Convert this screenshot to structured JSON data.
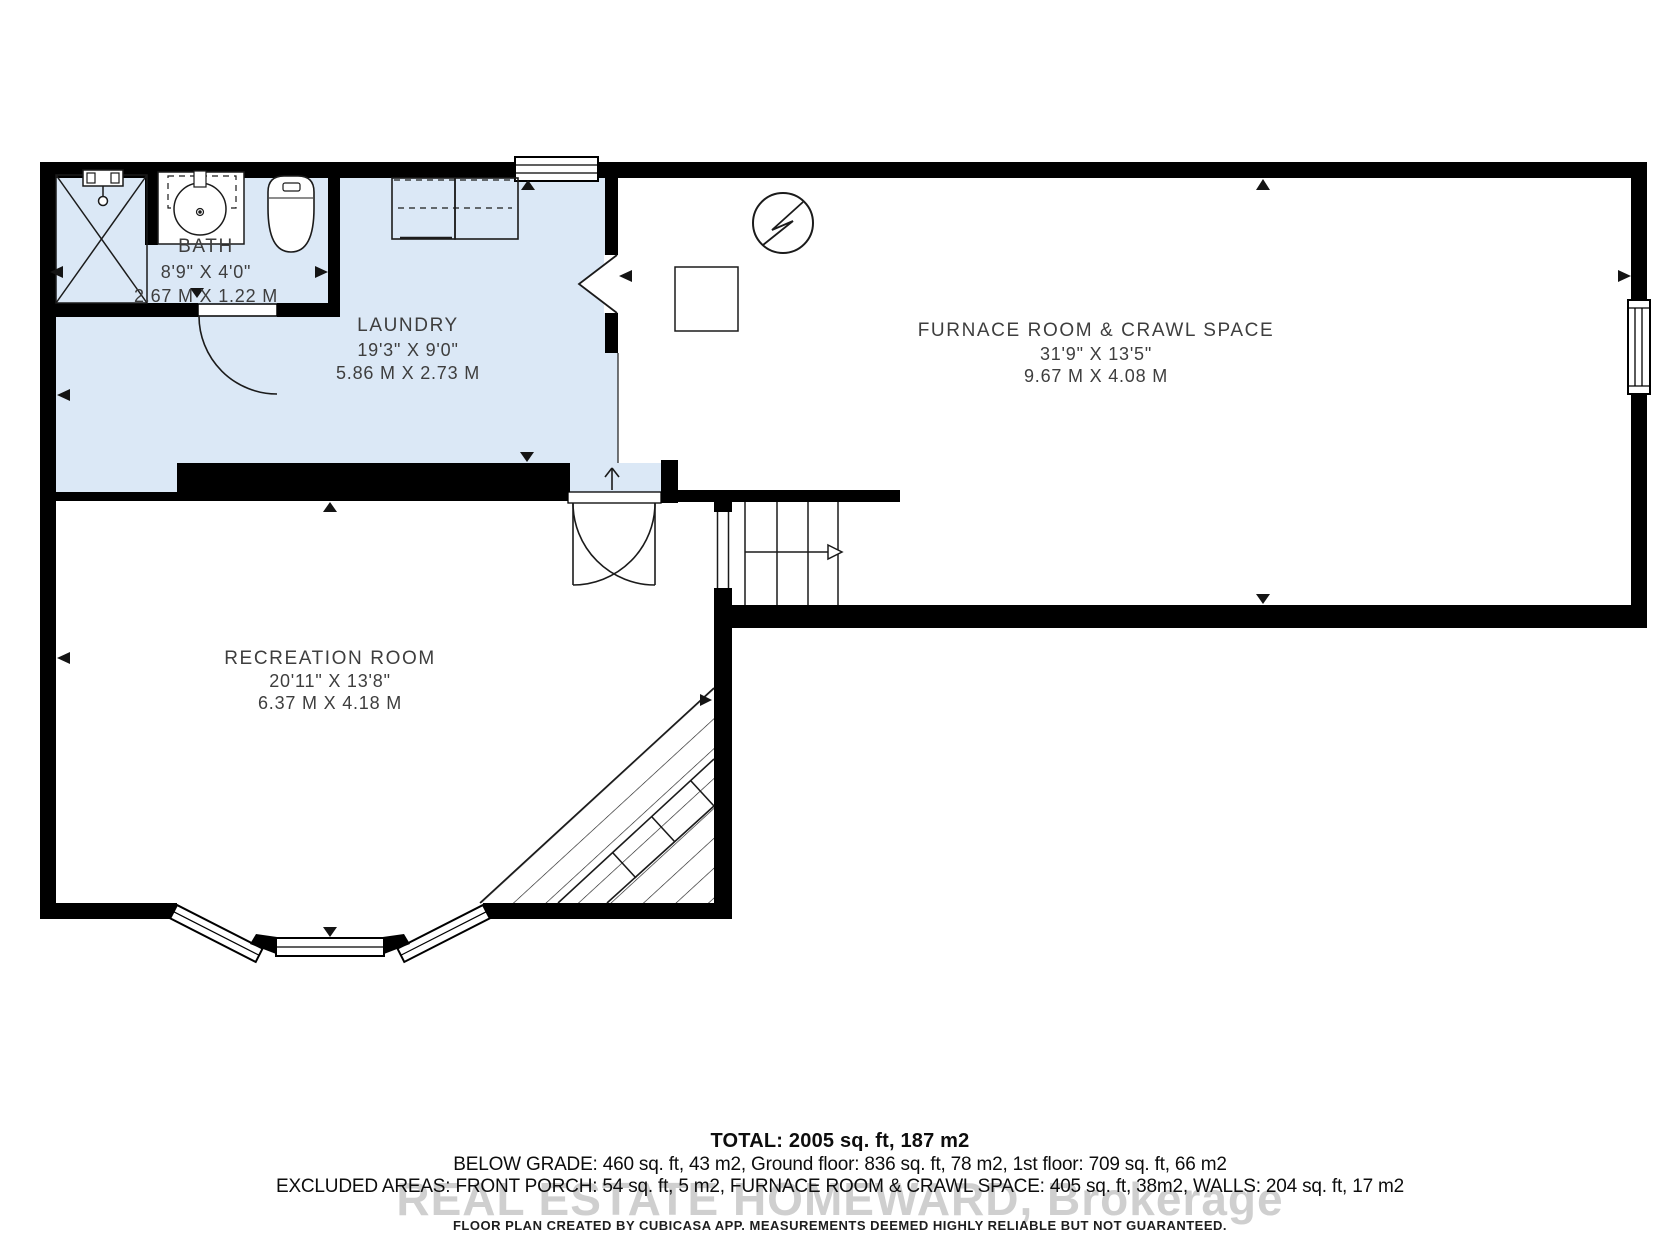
{
  "plan": {
    "rooms": {
      "bath": {
        "name": "BATH",
        "dim_ft": "8'9\" X 4'0\"",
        "dim_m": "2.67 M X 1.22 M"
      },
      "laundry": {
        "name": "LAUNDRY",
        "dim_ft": "19'3\" X 9'0\"",
        "dim_m": "5.86 M X 2.73 M"
      },
      "furnace": {
        "name": "FURNACE ROOM & CRAWL SPACE",
        "dim_ft": "31'9\" X 13'5\"",
        "dim_m": "9.67 M X 4.08 M"
      },
      "recreation": {
        "name": "RECREATION ROOM",
        "dim_ft": "20'11\" X 13'8\"",
        "dim_m": "6.37 M X 4.18 M"
      }
    },
    "icons": {
      "electrical_panel": "circle-with-lightning-bolt",
      "stairs_direction": "open-arrow",
      "under_stair_area": "diagonal-hatch"
    }
  },
  "summary": {
    "total": "TOTAL: 2005 sq. ft, 187 m2",
    "line2": "BELOW GRADE: 460 sq. ft, 43 m2, Ground floor: 836 sq. ft, 78 m2, 1st floor: 709 sq. ft, 66 m2",
    "line3": "EXCLUDED AREAS: FRONT PORCH: 54 sq. ft, 5 m2, FURNACE ROOM & CRAWL SPACE: 405 sq. ft, 38m2, WALLS: 204 sq. ft, 17 m2",
    "watermark": "REAL ESTATE HOMEWARD, Brokerage",
    "disclaimer": "FLOOR PLAN CREATED BY CUBICASA APP. MEASUREMENTS DEEMED HIGHLY RELIABLE BUT NOT GUARANTEED."
  },
  "colors": {
    "wall": "#000000",
    "highlight_area": "#dbe8f6",
    "label_text": "#3e3e3e",
    "watermark": "#bdbdbd"
  }
}
